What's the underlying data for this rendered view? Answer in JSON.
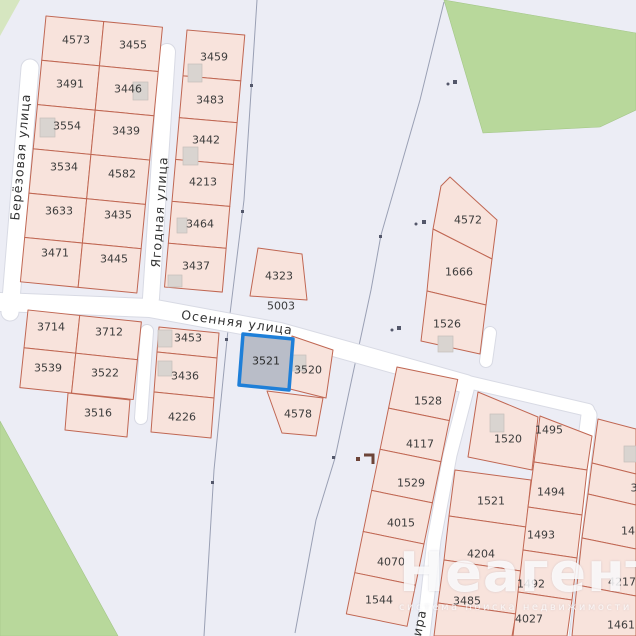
{
  "map": {
    "colors": {
      "bg": "#ecedf5",
      "road": "#ffffff",
      "green": "#b8d89b",
      "parcel-fill": "#f8e3dc",
      "parcel-border": "#c06753",
      "sel-fill": "#b9bdc8",
      "sel-border": "#1e7fd8"
    },
    "streets": {
      "left_vertical": "Берёзовая улица",
      "middle_vertical": "Ягодная улица",
      "horizontal": "Осенняя улица",
      "bottom_fragment": "ира"
    },
    "selected_parcel_id": "3521",
    "parcels": [
      {
        "label": "4573",
        "x": 76,
        "y": 40
      },
      {
        "label": "3455",
        "x": 133,
        "y": 45
      },
      {
        "label": "3491",
        "x": 70,
        "y": 84
      },
      {
        "label": "3446",
        "x": 128,
        "y": 89
      },
      {
        "label": "3554",
        "x": 67,
        "y": 126
      },
      {
        "label": "3439",
        "x": 126,
        "y": 131
      },
      {
        "label": "3534",
        "x": 64,
        "y": 167
      },
      {
        "label": "4582",
        "x": 122,
        "y": 174
      },
      {
        "label": "3633",
        "x": 59,
        "y": 211
      },
      {
        "label": "3435",
        "x": 118,
        "y": 215
      },
      {
        "label": "3471",
        "x": 55,
        "y": 253
      },
      {
        "label": "3445",
        "x": 114,
        "y": 259
      },
      {
        "label": "3459",
        "x": 214,
        "y": 57
      },
      {
        "label": "3483",
        "x": 210,
        "y": 100
      },
      {
        "label": "3442",
        "x": 206,
        "y": 140
      },
      {
        "label": "4213",
        "x": 203,
        "y": 182
      },
      {
        "label": "3464",
        "x": 200,
        "y": 224
      },
      {
        "label": "3437",
        "x": 196,
        "y": 266
      },
      {
        "label": "3714",
        "x": 51,
        "y": 327
      },
      {
        "label": "3712",
        "x": 109,
        "y": 332
      },
      {
        "label": "3539",
        "x": 48,
        "y": 368
      },
      {
        "label": "3522",
        "x": 105,
        "y": 373
      },
      {
        "label": "3516",
        "x": 98,
        "y": 413
      },
      {
        "label": "3453",
        "x": 188,
        "y": 338
      },
      {
        "label": "3436",
        "x": 185,
        "y": 376
      },
      {
        "label": "4226",
        "x": 182,
        "y": 417
      },
      {
        "label": "4323",
        "x": 279,
        "y": 276
      },
      {
        "label": "5003",
        "x": 281,
        "y": 306
      },
      {
        "label": "3521",
        "x": 266,
        "y": 361,
        "selected": true
      },
      {
        "label": "3520",
        "x": 308,
        "y": 370
      },
      {
        "label": "4578",
        "x": 298,
        "y": 414
      },
      {
        "label": "4572",
        "x": 468,
        "y": 220
      },
      {
        "label": "1666",
        "x": 459,
        "y": 272
      },
      {
        "label": "1526",
        "x": 447,
        "y": 324
      },
      {
        "label": "1528",
        "x": 428,
        "y": 401
      },
      {
        "label": "4117",
        "x": 420,
        "y": 444
      },
      {
        "label": "1529",
        "x": 411,
        "y": 483
      },
      {
        "label": "4015",
        "x": 401,
        "y": 523
      },
      {
        "label": "4070",
        "x": 391,
        "y": 562
      },
      {
        "label": "1544",
        "x": 379,
        "y": 600
      },
      {
        "label": "1520",
        "x": 508,
        "y": 439
      },
      {
        "label": "1521",
        "x": 491,
        "y": 501
      },
      {
        "label": "4204",
        "x": 481,
        "y": 554
      },
      {
        "label": "3485",
        "x": 467,
        "y": 601
      },
      {
        "label": "1495",
        "x": 549,
        "y": 430
      },
      {
        "label": "1494",
        "x": 551,
        "y": 492
      },
      {
        "label": "1493",
        "x": 541,
        "y": 535
      },
      {
        "label": "1492",
        "x": 531,
        "y": 584
      },
      {
        "label": "4027",
        "x": 529,
        "y": 619
      },
      {
        "label": "3",
        "x": 634,
        "y": 488
      },
      {
        "label": "14",
        "x": 628,
        "y": 531
      },
      {
        "label": "4217",
        "x": 622,
        "y": 582
      },
      {
        "label": "1461",
        "x": 621,
        "y": 625
      }
    ],
    "watermark": {
      "title": "Неагент",
      "subtitle": "система поиска недвижимости"
    }
  }
}
